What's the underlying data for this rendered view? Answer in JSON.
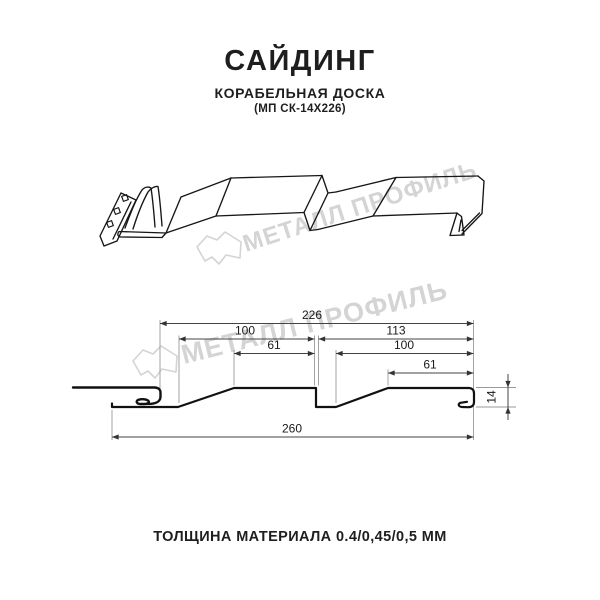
{
  "header": {
    "title": "САЙДИНГ",
    "subtitle": "КОРАБЕЛЬНАЯ ДОСКА",
    "code": "(МП СК-14Х226)"
  },
  "watermark": {
    "brand": "МЕТАЛЛ ПРОФИЛЬ",
    "logo_icon": "house-logo-icon",
    "color": "#d4d4d4"
  },
  "diagram": {
    "views": [
      "perspective-view",
      "cross-section-view"
    ],
    "dims": {
      "overall_width": "226",
      "wave1_width": "100",
      "wave2_full_width": "113",
      "wave1_flat": "61",
      "wave2_width": "100",
      "wave2_flat": "61",
      "total_width": "260",
      "profile_height": "14"
    }
  },
  "footer": {
    "thickness_note": "ТОЛЩИНА МАТЕРИАЛА 0.4/0,45/0,5 ММ"
  },
  "colors": {
    "profile_line": "#141414",
    "dim_line": "#444444",
    "ext_line": "#999999",
    "watermark": "#d4d4d4",
    "background": "#ffffff"
  }
}
